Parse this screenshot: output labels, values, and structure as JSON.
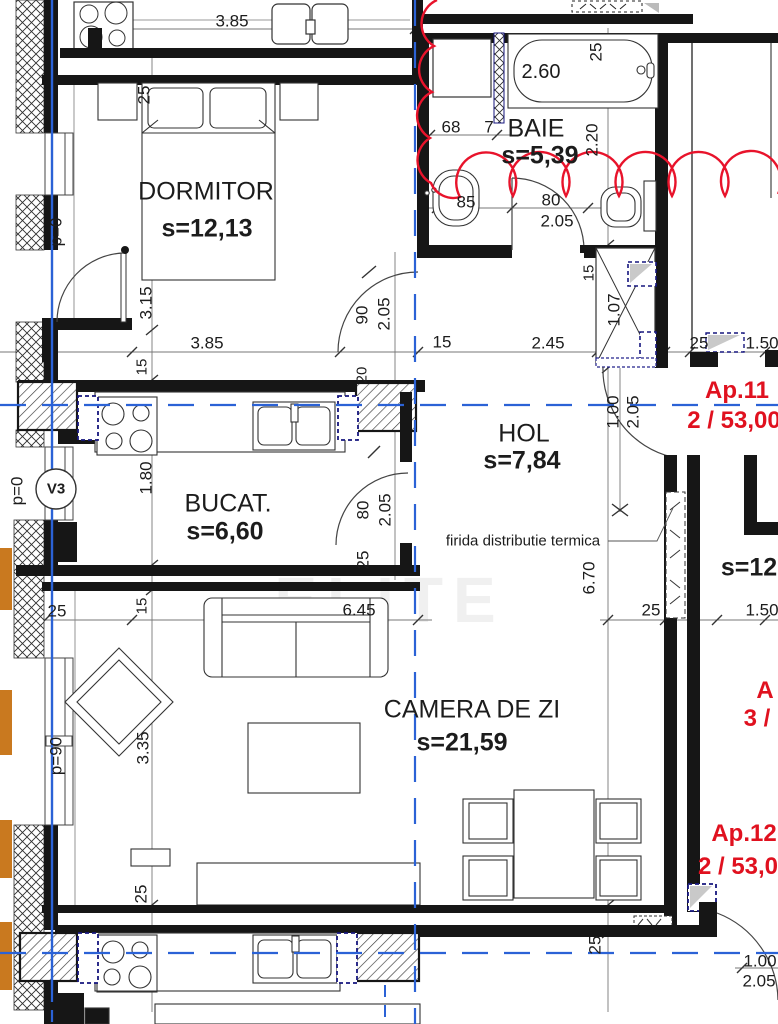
{
  "rooms": {
    "dormitor": {
      "name": "DORMITOR",
      "area": "s=12,13"
    },
    "baie": {
      "name": "BAIE",
      "area": "s=5,39"
    },
    "hol": {
      "name": "HOL",
      "area": "s=7,84"
    },
    "bucatarie": {
      "name": "BUCAT.",
      "area": "s=6,60"
    },
    "camera_de_zi": {
      "name": "CAMERA DE ZI",
      "area": "s=21,59"
    },
    "vecin_partial": {
      "area": "s=12"
    }
  },
  "apartments": {
    "ap11": {
      "name": "Ap.11",
      "info": "2 / 53,00"
    },
    "ap_right_partial": {
      "name": "A",
      "info": "3 /"
    },
    "ap12": {
      "name": "Ap.12",
      "info": "2 / 53,0"
    }
  },
  "annotations": {
    "firida": "firida distributie termica",
    "p0": "p=0",
    "p90": "p=90",
    "v3": "V3",
    "watermark": "ELITE"
  },
  "dims": {
    "d385a": "3.85",
    "d25a": "25",
    "d260": "2.60",
    "d25b": "25",
    "d68": "68",
    "d7": "7",
    "d220": "2.20",
    "d85": "85",
    "d80a": "80",
    "d205a": "2.05",
    "d15a": "15",
    "d107": "1.07",
    "d315": "3.15",
    "d385b": "3.85",
    "d90": "90",
    "d205b": "2.05",
    "d15b": "15",
    "d245": "2.45",
    "d25c": "25",
    "d150a": "1.50",
    "d15c": "15",
    "d20": "20",
    "d100a": "1.00",
    "d205c": "2.05",
    "d180": "1.80",
    "d80b": "80",
    "d205d": "2.05",
    "d25d": "25",
    "d670": "6.70",
    "d25e": "25",
    "d150b": "1.50",
    "d25f": "25",
    "d15d": "15",
    "d645": "6.45",
    "d335": "3.35",
    "d25g": "25",
    "d25h": "25",
    "d100b": "1.00",
    "d205e": "2.05"
  },
  "colors": {
    "wall": "#161616",
    "axis_blue": "#2b62d6",
    "revision_red": "#e8132b",
    "insulation_orange": "#c9791f",
    "vent_navy": "#16167e"
  }
}
